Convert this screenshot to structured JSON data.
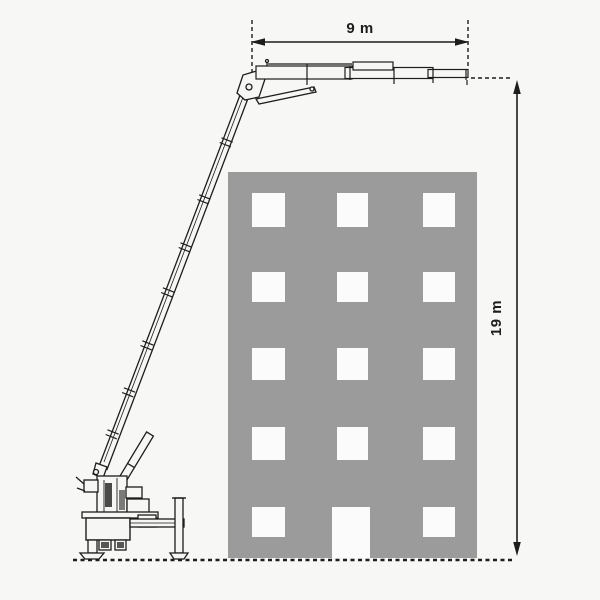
{
  "diagram": {
    "subject": "crane-reach-over-building",
    "labels": {
      "horizontal_reach": "9 m",
      "vertical_height": "19 m"
    },
    "colors": {
      "background": "#f7f7f6",
      "building_fill": "#9b9b9b",
      "window_fill": "#fbfbfb",
      "line": "#1d1d1b"
    },
    "building": {
      "window_rows": 5,
      "window_columns": 3
    }
  }
}
